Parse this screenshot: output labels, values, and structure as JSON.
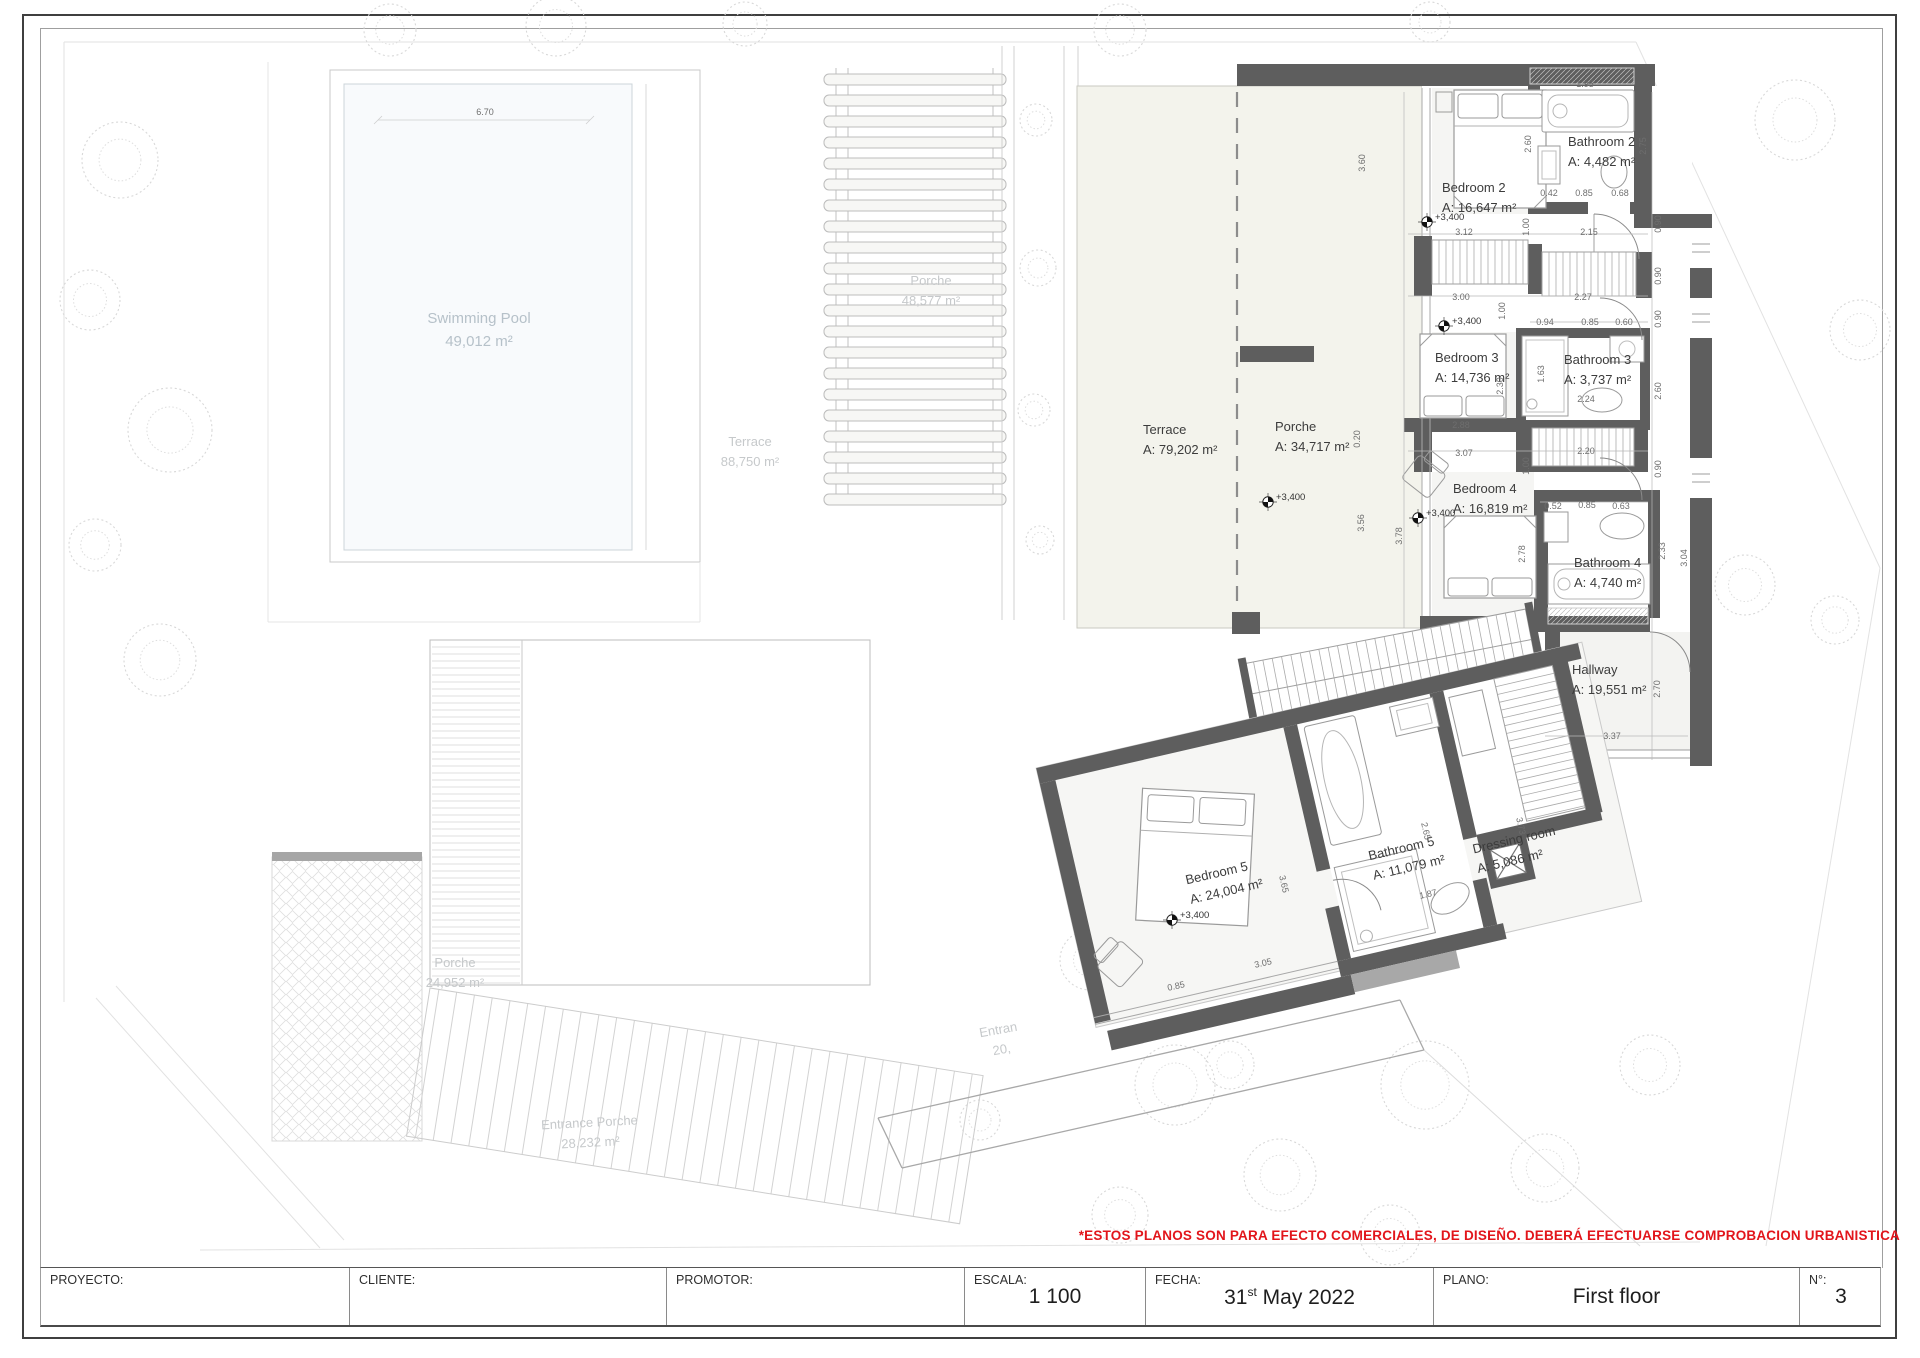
{
  "sheet": {
    "disclaimer": "*ESTOS PLANOS SON PARA EFECTO COMERCIALES, DE DISEÑO. DEBERÁ EFECTUARSE COMPROBACION URBANISTICA"
  },
  "title_block": {
    "proyecto": {
      "label": "PROYECTO:",
      "value": ""
    },
    "cliente": {
      "label": "CLIENTE:",
      "value": ""
    },
    "promotor": {
      "label": "PROMOTOR:",
      "value": ""
    },
    "escala": {
      "label": "ESCALA:",
      "value": "1 100"
    },
    "fecha": {
      "label": "FECHA:",
      "day": "31",
      "ordinal": "st",
      "rest": "May 2022"
    },
    "plano": {
      "label": "PLANO:",
      "value": "First floor"
    },
    "numero": {
      "label": "N°:",
      "value": "3"
    }
  },
  "plan": {
    "rooms": [
      {
        "id": "bedroom-2",
        "name": "Bedroom 2",
        "area": "A: 16,647 m²",
        "x": 1442,
        "y": 198,
        "r": 0,
        "align": "left"
      },
      {
        "id": "bathroom-2",
        "name": "Bathroom 2",
        "area": "A: 4,482 m²",
        "x": 1568,
        "y": 152,
        "r": 0,
        "align": "left"
      },
      {
        "id": "bedroom-3",
        "name": "Bedroom 3",
        "area": "A: 14,736 m²",
        "x": 1435,
        "y": 368,
        "r": 0,
        "align": "left"
      },
      {
        "id": "bathroom-3",
        "name": "Bathroom 3",
        "area": "A: 3,737 m²",
        "x": 1564,
        "y": 370,
        "r": 0,
        "align": "left"
      },
      {
        "id": "bedroom-4",
        "name": "Bedroom 4",
        "area": "A: 16,819 m²",
        "x": 1453,
        "y": 499,
        "r": 0,
        "align": "left"
      },
      {
        "id": "bathroom-4",
        "name": "Bathroom 4",
        "area": "A: 4,740 m²",
        "x": 1574,
        "y": 573,
        "r": 0,
        "align": "left"
      },
      {
        "id": "hallway",
        "name": "Hallway",
        "area": "A: 19,551 m²",
        "x": 1572,
        "y": 680,
        "r": 0,
        "align": "left"
      },
      {
        "id": "terrace-main",
        "name": "Terrace",
        "area": "A: 79,202 m²",
        "x": 1143,
        "y": 440,
        "r": 0,
        "align": "left"
      },
      {
        "id": "porche-main",
        "name": "Porche",
        "area": "A: 34,717 m²",
        "x": 1275,
        "y": 437,
        "r": 0,
        "align": "left"
      },
      {
        "id": "bedroom-5",
        "name": "Bedroom 5",
        "area": "A: 24,004 m²",
        "x": 1187,
        "y": 882,
        "r": -13,
        "align": "left"
      },
      {
        "id": "bathroom-5",
        "name": "Bathroom 5",
        "area": "A: 11,079 m²",
        "x": 1370,
        "y": 858,
        "r": -13,
        "align": "left"
      },
      {
        "id": "dressing-room",
        "name": "Dressing room",
        "area": "A: 5,086 m²",
        "x": 1474,
        "y": 850,
        "r": -13,
        "align": "left"
      }
    ],
    "faint_labels": [
      {
        "id": "swimming-pool",
        "name": "Swimming Pool",
        "area": "49,012 m²",
        "x": 479,
        "y": 330,
        "r": 0,
        "cls": "pool-label"
      },
      {
        "id": "terrace-garden",
        "name": "Terrace",
        "area": "88,750 m²",
        "x": 750,
        "y": 452,
        "r": 0,
        "cls": "ent-label"
      },
      {
        "id": "porche-pergola",
        "name": "Porche",
        "area": "48,577 m²",
        "x": 931,
        "y": 291,
        "r": 0,
        "cls": "ent-label"
      },
      {
        "id": "porche-paving",
        "name": "Porche",
        "area": "24,952 m²",
        "x": 455,
        "y": 973,
        "r": 0,
        "cls": "ent-label"
      },
      {
        "id": "entrance-porche",
        "name": "Entrance Porche",
        "area": "28,232 m²",
        "x": 590,
        "y": 1133,
        "r": -3,
        "cls": "ent-label"
      },
      {
        "id": "entrance-partial",
        "name": "Entran",
        "area": "20,",
        "x": 1000,
        "y": 1040,
        "r": -10,
        "cls": "ent-label"
      }
    ],
    "level_markers": [
      {
        "text": "+3,400",
        "x": 1427,
        "y": 222
      },
      {
        "text": "+3,400",
        "x": 1444,
        "y": 326
      },
      {
        "text": "+3,400",
        "x": 1418,
        "y": 518
      },
      {
        "text": "+3,400",
        "x": 1268,
        "y": 502
      },
      {
        "text": "+3,400",
        "x": 1172,
        "y": 920
      }
    ],
    "dimensions": [
      {
        "t": "6.70",
        "x": 485,
        "y": 112,
        "r": 0
      },
      {
        "t": "3.60",
        "x": 1362,
        "y": 163,
        "r": -90
      },
      {
        "t": "2.60",
        "x": 1528,
        "y": 144,
        "r": -90
      },
      {
        "t": "1.95",
        "x": 1585,
        "y": 84,
        "r": 0
      },
      {
        "t": "2.75",
        "x": 1643,
        "y": 146,
        "r": -90
      },
      {
        "t": "0.42",
        "x": 1549,
        "y": 193,
        "r": 0
      },
      {
        "t": "0.85",
        "x": 1584,
        "y": 193,
        "r": 0
      },
      {
        "t": "0.68",
        "x": 1620,
        "y": 193,
        "r": 0
      },
      {
        "t": "1.00",
        "x": 1526,
        "y": 227,
        "r": -90
      },
      {
        "t": "2.15",
        "x": 1589,
        "y": 232,
        "r": 0
      },
      {
        "t": "0.90",
        "x": 1658,
        "y": 224,
        "r": -90
      },
      {
        "t": "3.12",
        "x": 1464,
        "y": 232,
        "r": 0
      },
      {
        "t": "3.00",
        "x": 1461,
        "y": 297,
        "r": 0
      },
      {
        "t": "2.27",
        "x": 1583,
        "y": 297,
        "r": 0
      },
      {
        "t": "1.00",
        "x": 1502,
        "y": 311,
        "r": -90
      },
      {
        "t": "0.90",
        "x": 1658,
        "y": 276,
        "r": -90
      },
      {
        "t": "0.90",
        "x": 1658,
        "y": 319,
        "r": -90
      },
      {
        "t": "0.94",
        "x": 1545,
        "y": 322,
        "r": 0
      },
      {
        "t": "0.85",
        "x": 1590,
        "y": 322,
        "r": 0
      },
      {
        "t": "0.60",
        "x": 1624,
        "y": 322,
        "r": 0
      },
      {
        "t": "2.30",
        "x": 1500,
        "y": 386,
        "r": -90
      },
      {
        "t": "1.63",
        "x": 1541,
        "y": 374,
        "r": -90
      },
      {
        "t": "2.24",
        "x": 1586,
        "y": 399,
        "r": 0
      },
      {
        "t": "2.88",
        "x": 1461,
        "y": 425,
        "r": 0
      },
      {
        "t": "3.07",
        "x": 1464,
        "y": 453,
        "r": 0
      },
      {
        "t": "2.20",
        "x": 1586,
        "y": 451,
        "r": 0
      },
      {
        "t": "2.60",
        "x": 1658,
        "y": 391,
        "r": -90
      },
      {
        "t": "1.00",
        "x": 1526,
        "y": 466,
        "r": -90
      },
      {
        "t": "0.52",
        "x": 1553,
        "y": 506,
        "r": 0
      },
      {
        "t": "0.85",
        "x": 1587,
        "y": 505,
        "r": 0
      },
      {
        "t": "0.63",
        "x": 1621,
        "y": 506,
        "r": 0
      },
      {
        "t": "2.78",
        "x": 1522,
        "y": 554,
        "r": -90
      },
      {
        "t": "3.78",
        "x": 1399,
        "y": 536,
        "r": -90
      },
      {
        "t": "2.33",
        "x": 1662,
        "y": 551,
        "r": -90
      },
      {
        "t": "3.04",
        "x": 1684,
        "y": 558,
        "r": -90
      },
      {
        "t": "0.90",
        "x": 1658,
        "y": 469,
        "r": -90
      },
      {
        "t": "2.70",
        "x": 1657,
        "y": 689,
        "r": -90
      },
      {
        "t": "3.37",
        "x": 1612,
        "y": 736,
        "r": 0
      },
      {
        "t": "0.20",
        "x": 1357,
        "y": 439,
        "r": -90
      },
      {
        "t": "3.56",
        "x": 1361,
        "y": 523,
        "r": -90
      },
      {
        "t": "3.65",
        "x": 1284,
        "y": 884,
        "r": 77
      },
      {
        "t": "1.87",
        "x": 1428,
        "y": 894,
        "r": -13
      },
      {
        "t": "3.05",
        "x": 1263,
        "y": 963,
        "r": -13
      },
      {
        "t": "0.85",
        "x": 1176,
        "y": 986,
        "r": -13
      },
      {
        "t": "3.73",
        "x": 1521,
        "y": 826,
        "r": 77
      },
      {
        "t": "2.65",
        "x": 1426,
        "y": 831,
        "r": 77
      }
    ]
  }
}
